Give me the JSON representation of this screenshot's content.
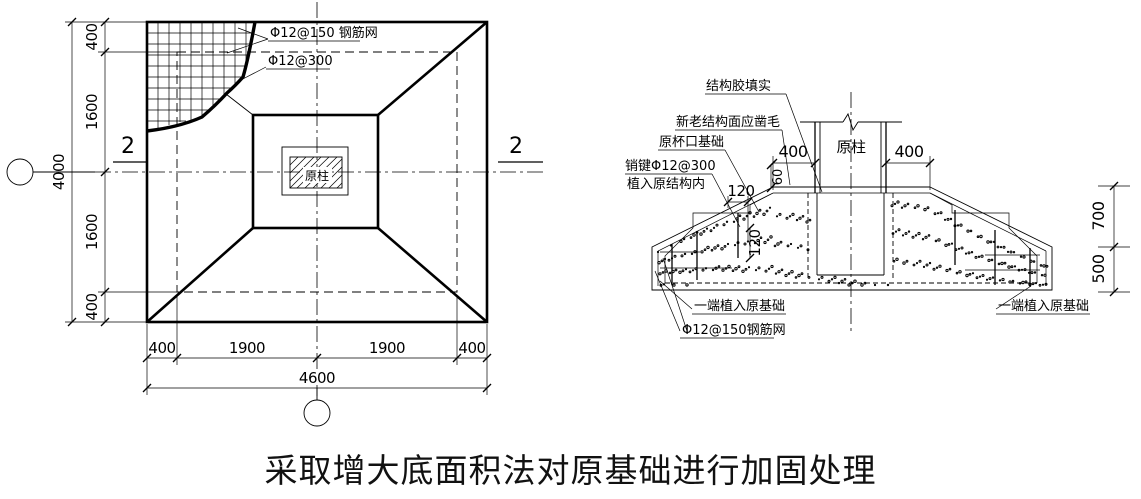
{
  "title": "采取增大底面积法对原基础进行加固处理",
  "plan_view": {
    "labels": {
      "mesh_note": "Φ12@150 钢筋网",
      "rebar_note": "Φ12@300",
      "column": "原柱",
      "section_marker_left": "2",
      "section_marker_right": "2"
    },
    "dimensions": {
      "left_segments": [
        "400",
        "1600",
        "1600",
        "400"
      ],
      "left_overall": "4000",
      "bottom_segments": [
        "400",
        "1900",
        "1900",
        "400"
      ],
      "bottom_overall": "4600"
    }
  },
  "section_view": {
    "labels": {
      "structural_glue": "结构胶填实",
      "roughen_surface": "新老结构面应凿毛",
      "original_cup_foundation": "原杯口基础",
      "dowel_spec": "销键Φ12@300",
      "dowel_embed": "植入原结构内",
      "embed_left": "一端植入原基础",
      "embed_right": "一端植入原基础",
      "mesh_note": "Φ12@150钢筋网",
      "column": "原柱"
    },
    "dimensions": {
      "col_left": "400",
      "col_right": "400",
      "step_60": "60",
      "key_120_h": "120",
      "key_120_v": "120",
      "height_700": "700",
      "height_500": "500"
    }
  },
  "colors": {
    "line": "#000000",
    "background": "#ffffff"
  }
}
